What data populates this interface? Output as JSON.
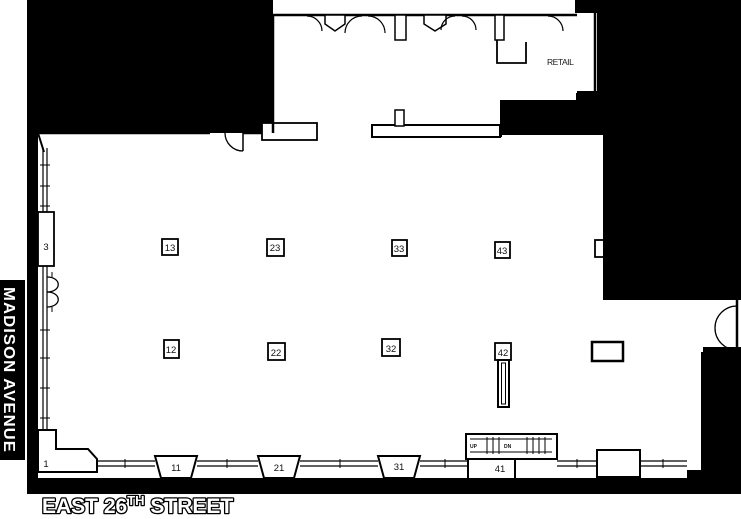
{
  "streets": {
    "madison": "MADISON AVENUE",
    "east26_prefix": "EAST 26",
    "east26_sup": "TH",
    "east26_suffix": " STREET"
  },
  "labels": {
    "retail": "RETAIL"
  },
  "escalator": {
    "up": "UP",
    "dn": "DN"
  },
  "columns": {
    "c13": "13",
    "c23": "23",
    "c33": "33",
    "c43": "43",
    "c12": "12",
    "c22": "22",
    "c32": "32",
    "c42": "42",
    "c11": "11",
    "c21": "21",
    "c31": "31",
    "c41": "41",
    "c3": "3",
    "c1": "1"
  },
  "colors": {
    "mask": "#000000",
    "wall": "#000000",
    "background": "#ffffff",
    "street_text": "#ffffff"
  }
}
